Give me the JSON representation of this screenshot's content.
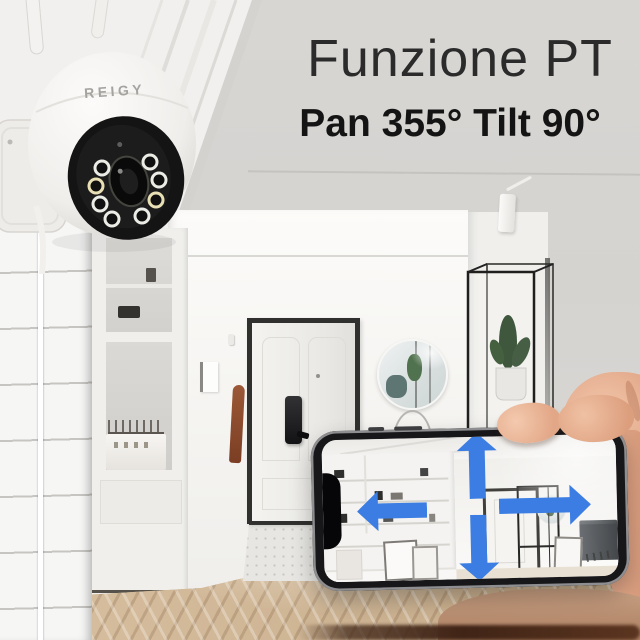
{
  "page": {
    "type": "product-marketing-image",
    "language": "Italian"
  },
  "headline": {
    "title": "Funzione PT",
    "subtitle": "Pan 355° Tilt 90°"
  },
  "camera": {
    "brand": "REIGY",
    "kind": "white dome PTZ security camera",
    "led_count": 8,
    "antenna_count": 2
  },
  "phone": {
    "screen_view": "live indoor camera view of hallway",
    "notch": true,
    "arrows": [
      {
        "direction": "up"
      },
      {
        "direction": "down"
      },
      {
        "direction": "left"
      },
      {
        "direction": "right"
      }
    ]
  },
  "scene": {
    "elements": [
      "camera mounted beside white staircase wall",
      "white hallway with black-framed front door and smart lock",
      "round wall mirror reflecting cactus",
      "black metal display shelf with potted cactus",
      "built-in white cabinet with wire basket",
      "herringbone wood floor",
      "hand holding smartphone"
    ]
  },
  "colors": {
    "background": "#d6d4d1",
    "headline_text": "#222222",
    "arrow_blue": "#3b7de2",
    "camera_body": "#f6f5f3",
    "camera_face": "#171717",
    "hand_skin": "#e8b094"
  }
}
